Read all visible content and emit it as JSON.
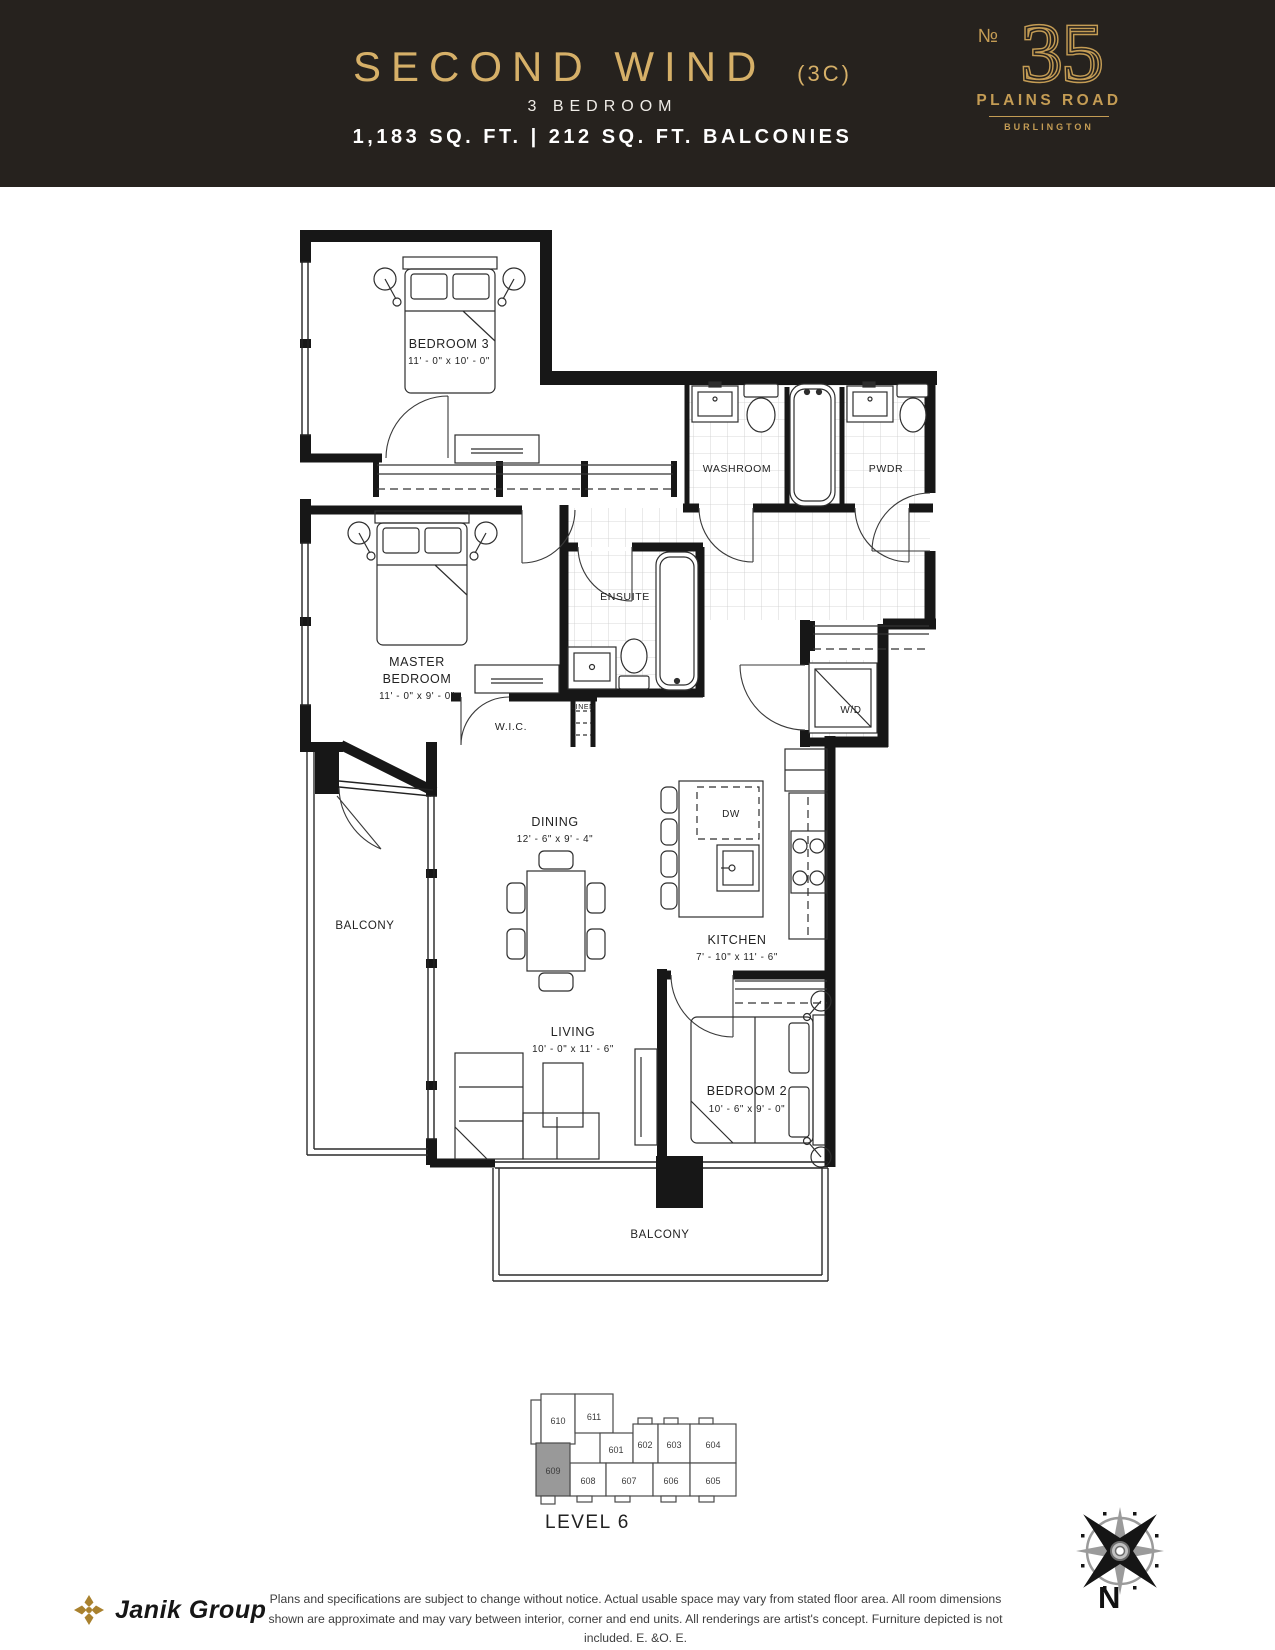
{
  "header": {
    "title": "SECOND WIND",
    "variant": "(3C)",
    "subtitle": "3 BEDROOM",
    "area": "1,183 SQ. FT. | 212 SQ. FT. BALCONIES",
    "bg_color": "#26221e",
    "gold": "#d6b068"
  },
  "logo": {
    "no": "№",
    "number": "35",
    "street": "PLAINS ROAD",
    "city": "BURLINGTON",
    "gold": "#c49c54"
  },
  "plan": {
    "rooms": {
      "bedroom3": {
        "name": "BEDROOM 3",
        "dims": "11' - 0\" x 10' - 0\""
      },
      "washroom": {
        "name": "WASHROOM"
      },
      "pwdr": {
        "name": "PWDR"
      },
      "master": {
        "line1": "MASTER",
        "line2": "BEDROOM",
        "dims": "11' - 0\" x 9' - 0\""
      },
      "ensuite": {
        "name": "ENSUITE"
      },
      "wic": {
        "name": "W.I.C."
      },
      "linen": {
        "name": "LINEN"
      },
      "wd": {
        "name": "W/D"
      },
      "dw": {
        "name": "DW"
      },
      "dining": {
        "name": "DINING",
        "dims": "12' - 6\" x 9' - 4\""
      },
      "kitchen": {
        "name": "KITCHEN",
        "dims": "7' - 10\" x 11' - 6\""
      },
      "living": {
        "name": "LIVING",
        "dims": "10' - 0\" x 11' - 6\""
      },
      "bedroom2": {
        "name": "BEDROOM 2",
        "dims": "10' - 6\" x 9' - 0\""
      },
      "balcony_left": {
        "name": "BALCONY"
      },
      "balcony_bottom": {
        "name": "BALCONY"
      }
    }
  },
  "keyplan": {
    "level": "LEVEL 6",
    "highlighted_unit": "609",
    "highlight_color": "#999999",
    "units": [
      "610",
      "611",
      "601",
      "602",
      "603",
      "604",
      "609",
      "608",
      "607",
      "606",
      "605"
    ]
  },
  "footer": {
    "brand": "Janik Group",
    "disclaimer_line1": "Plans and specifications are subject to change without notice. Actual usable space may vary from stated floor area. All room dimensions",
    "disclaimer_line2": "shown are approximate and may vary between interior, corner and end units. All renderings are artist's concept. Furniture depicted is not included. E. &O. E.",
    "compass": "N"
  }
}
